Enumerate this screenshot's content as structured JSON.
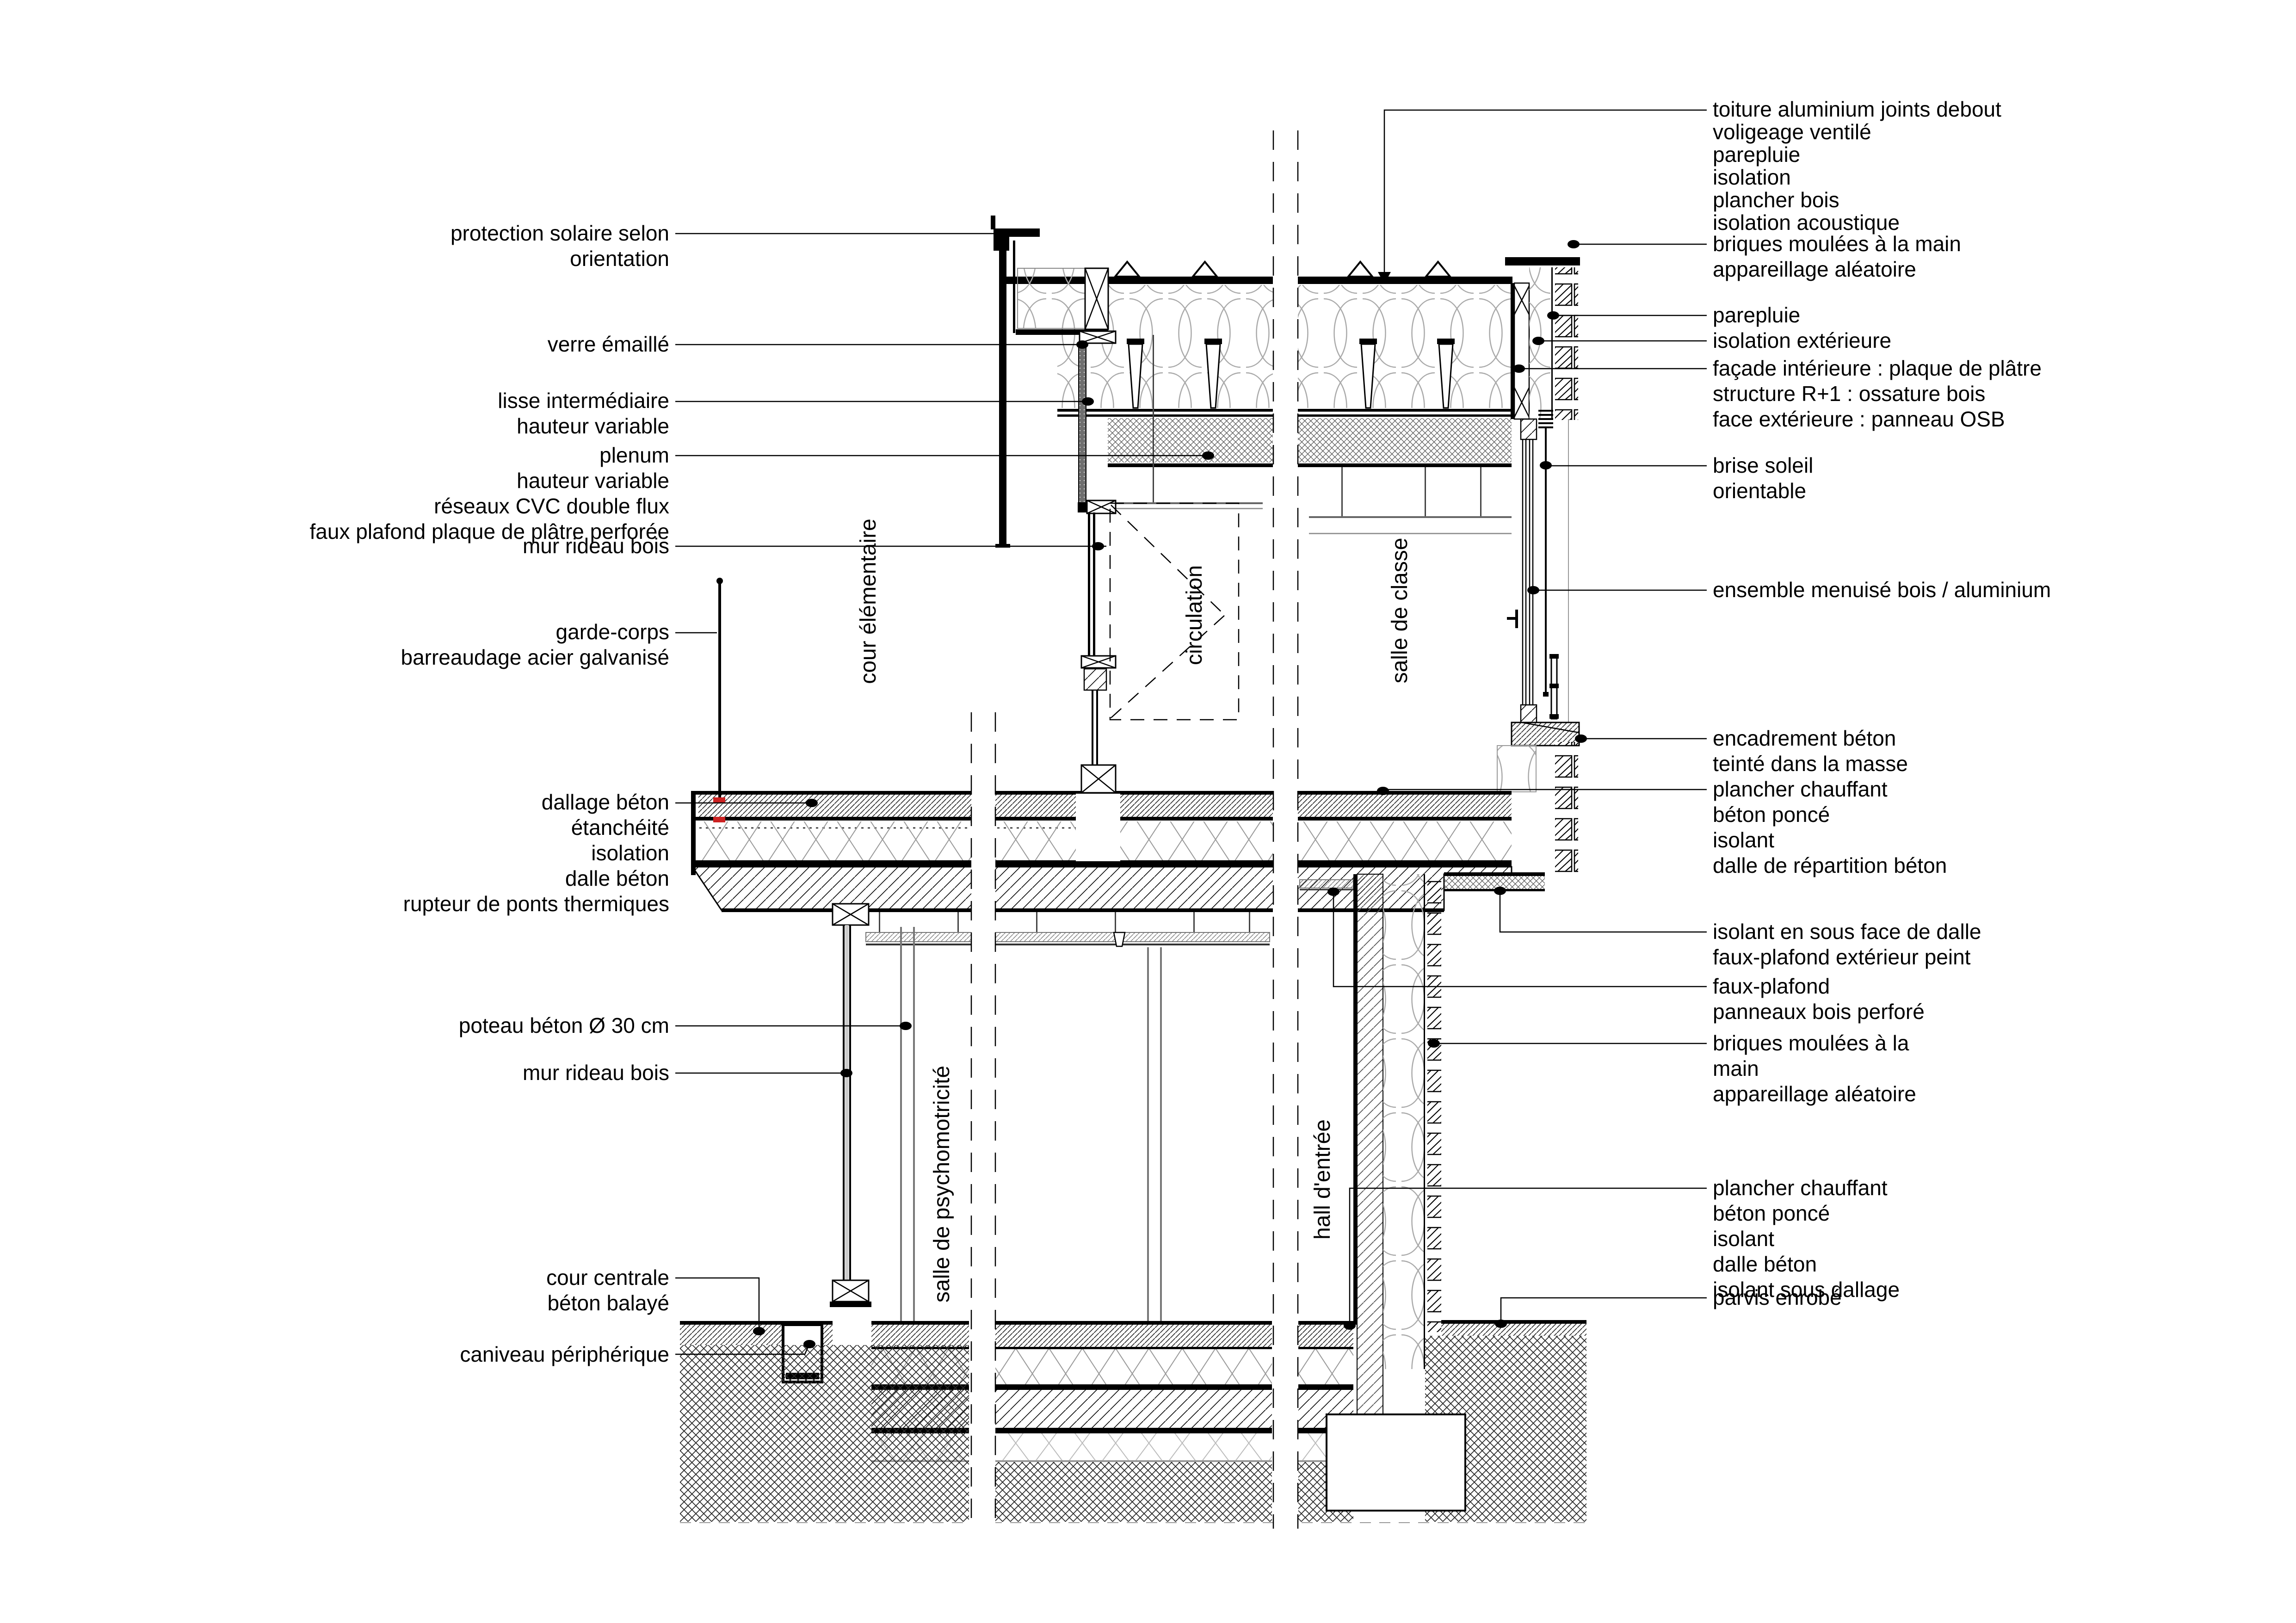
{
  "drawing": {
    "kind": "architectural construction section detail",
    "language": "fr",
    "background": "#ffffff",
    "line_color": "#000000",
    "pattern_color": "#9a9a9a",
    "fixing_color": "#cc2222",
    "glass_color": "#6f6f6f"
  },
  "annotations_left": [
    {
      "id": "protection-solaire",
      "lines": [
        "protection solaire selon",
        "orientation"
      ]
    },
    {
      "id": "verre-emaille",
      "lines": [
        "verre émaillé"
      ]
    },
    {
      "id": "lisse-intermediaire",
      "lines": [
        "lisse intermédiaire",
        "hauteur variable"
      ]
    },
    {
      "id": "plenum",
      "lines": [
        "plenum",
        "hauteur variable",
        "réseaux CVC double flux",
        "faux plafond plaque de plâtre perforée"
      ]
    },
    {
      "id": "mur-rideau-bois-haut",
      "lines": [
        "mur rideau bois"
      ]
    },
    {
      "id": "garde-corps",
      "lines": [
        "garde-corps",
        "barreaudage acier galvanisé"
      ]
    },
    {
      "id": "dallage-beton",
      "lines": [
        "dallage béton",
        "étanchéité",
        "isolation",
        "dalle béton",
        "rupteur de ponts thermiques"
      ]
    },
    {
      "id": "poteau-beton",
      "lines": [
        "poteau béton Ø 30 cm"
      ]
    },
    {
      "id": "mur-rideau-bois-bas",
      "lines": [
        "mur rideau bois"
      ]
    },
    {
      "id": "cour-centrale",
      "lines": [
        "cour centrale",
        "béton balayé"
      ]
    },
    {
      "id": "caniveau",
      "lines": [
        "caniveau périphérique"
      ]
    }
  ],
  "annotations_right": [
    {
      "id": "toiture",
      "lines": [
        "toiture aluminium joints debout",
        "voligeage ventilé",
        "parepluie",
        "isolation",
        "plancher bois",
        "isolation acoustique"
      ]
    },
    {
      "id": "briques-haut",
      "lines": [
        "briques moulées à la main",
        "appareillage aléatoire"
      ]
    },
    {
      "id": "parepluie",
      "lines": [
        "parepluie"
      ]
    },
    {
      "id": "isolation-exterieure",
      "lines": [
        "isolation extérieure"
      ]
    },
    {
      "id": "facade",
      "lines": [
        "façade intérieure : plaque de plâtre",
        "structure R+1 : ossature bois",
        "face extérieure : panneau OSB"
      ]
    },
    {
      "id": "brise-soleil",
      "lines": [
        "brise soleil",
        "orientable"
      ]
    },
    {
      "id": "ensemble-menuise",
      "lines": [
        "ensemble menuisé bois / aluminium"
      ]
    },
    {
      "id": "encadrement",
      "lines": [
        "encadrement béton",
        "teinté dans la masse",
        "plancher chauffant",
        "béton poncé",
        "isolant",
        "dalle de répartition béton"
      ]
    },
    {
      "id": "isolant-sous-face",
      "lines": [
        "isolant en sous face de dalle",
        "faux-plafond extérieur peint"
      ]
    },
    {
      "id": "faux-plafond",
      "lines": [
        "faux-plafond",
        "panneaux bois perforé"
      ]
    },
    {
      "id": "briques-bas",
      "lines": [
        "briques moulées à la",
        "main",
        "appareillage aléatoire"
      ]
    },
    {
      "id": "plancher-rdc",
      "lines": [
        "plancher chauffant",
        "béton poncé",
        "isolant",
        "dalle béton",
        "isolant sous dallage"
      ]
    },
    {
      "id": "parvis",
      "lines": [
        "parvis enrobé"
      ]
    }
  ],
  "rooms": [
    {
      "id": "cour-elementaire",
      "label": "cour élémentaire"
    },
    {
      "id": "circulation",
      "label": "circulation"
    },
    {
      "id": "salle-de-classe",
      "label": "salle de classe"
    },
    {
      "id": "salle-de-psychomotricite",
      "label": "salle de psychomotricité"
    },
    {
      "id": "hall-entree",
      "label": "hall d'entrée"
    }
  ]
}
